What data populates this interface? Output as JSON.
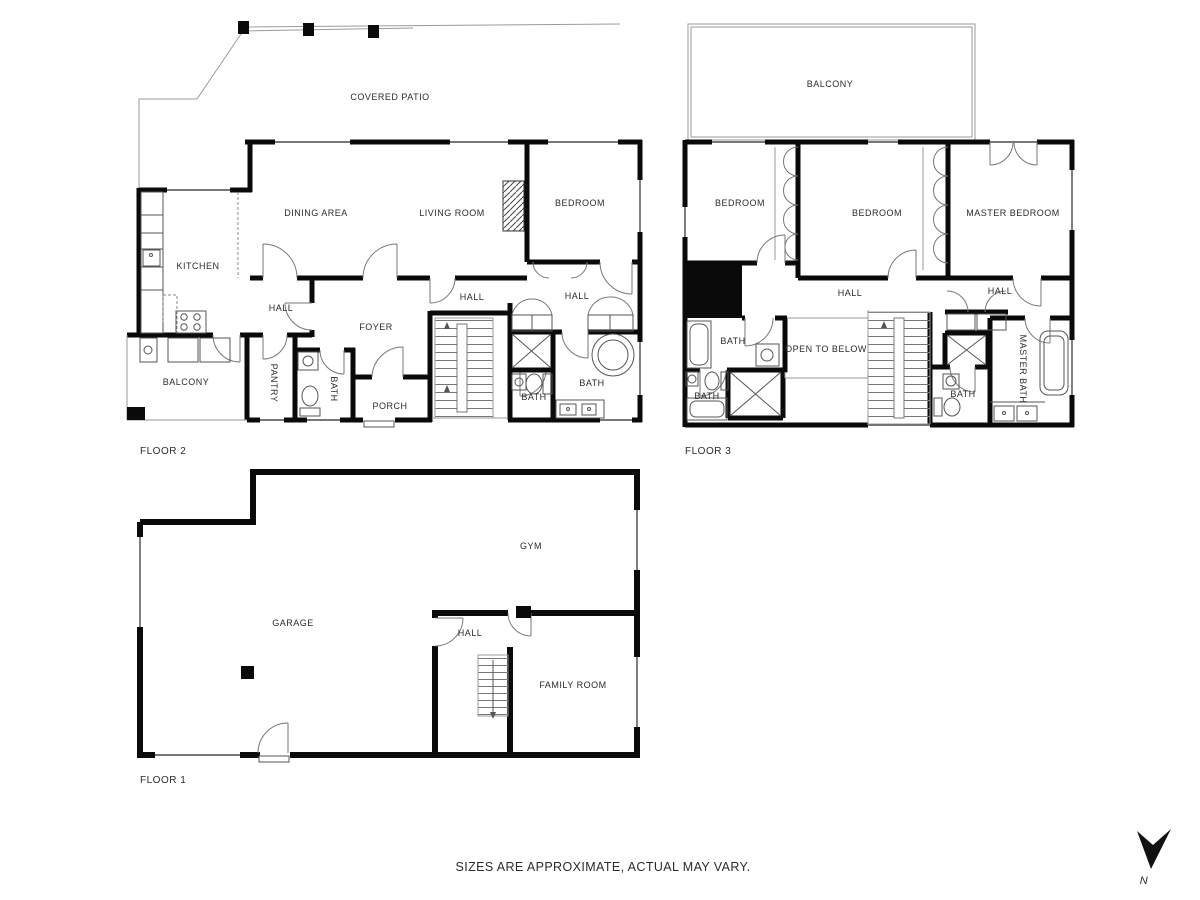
{
  "page": {
    "disclaimer": "SIZES ARE APPROXIMATE, ACTUAL MAY VARY.",
    "compass_label": "N"
  },
  "colors": {
    "wall": "#0a0a0a",
    "background": "#ffffff",
    "thin_line": "#9a9a9a",
    "label_text": "#2b2b2b"
  },
  "floor2": {
    "name": "FLOOR 2",
    "rooms": {
      "covered_patio": "COVERED PATIO",
      "dining_area": "DINING AREA",
      "living_room": "LIVING ROOM",
      "bedroom": "BEDROOM",
      "kitchen": "KITCHEN",
      "hall_west": "HALL",
      "hall_center": "HALL",
      "hall_east": "HALL",
      "foyer": "FOYER",
      "balcony": "BALCONY",
      "pantry": "PANTRY",
      "bath_west": "BATH",
      "porch": "PORCH",
      "bath_small": "BATH",
      "bath_main": "BATH"
    }
  },
  "floor3": {
    "name": "FLOOR 3",
    "rooms": {
      "balcony": "BALCONY",
      "bedroom_west": "BEDROOM",
      "bedroom_center": "BEDROOM",
      "master_bedroom": "MASTER BEDROOM",
      "hall_center": "HALL",
      "hall_east": "HALL",
      "bath_west": "BATH",
      "bath_southwest": "BATH",
      "open_to_below": "OPEN TO BELOW",
      "bath_center": "BATH",
      "master_bath": "MASTER BATH"
    }
  },
  "floor1": {
    "name": "FLOOR 1",
    "rooms": {
      "gym": "GYM",
      "garage": "GARAGE",
      "hall": "HALL",
      "family_room": "FAMILY ROOM"
    }
  }
}
